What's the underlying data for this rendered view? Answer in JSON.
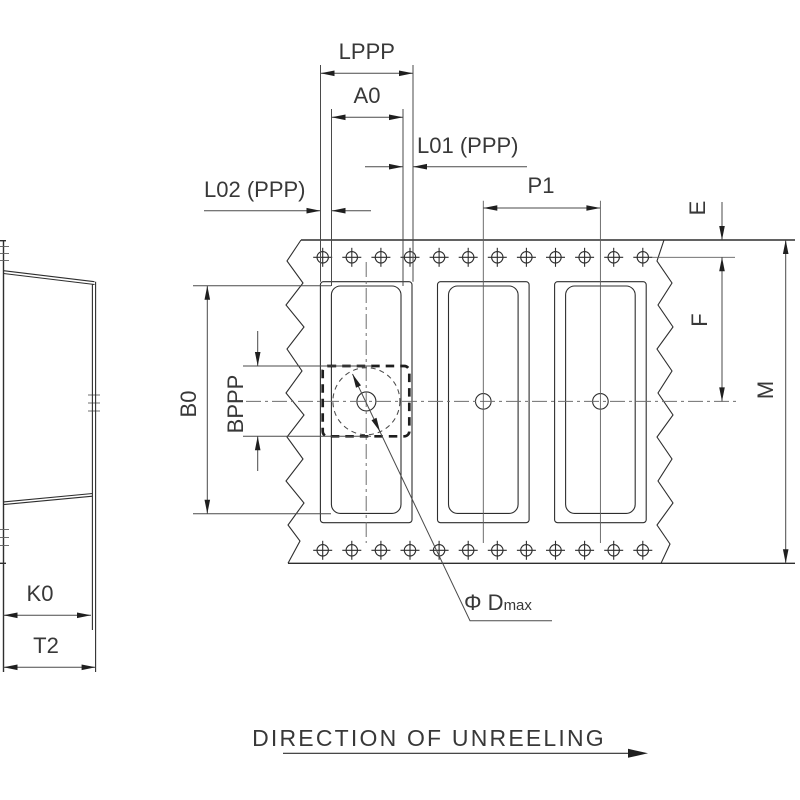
{
  "labels": {
    "lppp": "LPPP",
    "a0": "A0",
    "l01": "L01 (PPP)",
    "l02": "L02 (PPP)",
    "p1": "P1",
    "e": "E",
    "f": "F",
    "m": "M",
    "b0": "B0",
    "bppp": "BPPP",
    "k0": "K0",
    "t2": "T2",
    "dmax": "Φ D",
    "dmax_sub": "max"
  },
  "footer": {
    "direction_text": "DIRECTION OF UNREELING"
  },
  "colors": {
    "background": "#ffffff",
    "outline": "#2e2e2e",
    "dimension": "#4a4a4a",
    "centerline": "#6e6e6e",
    "text": "#383838"
  }
}
